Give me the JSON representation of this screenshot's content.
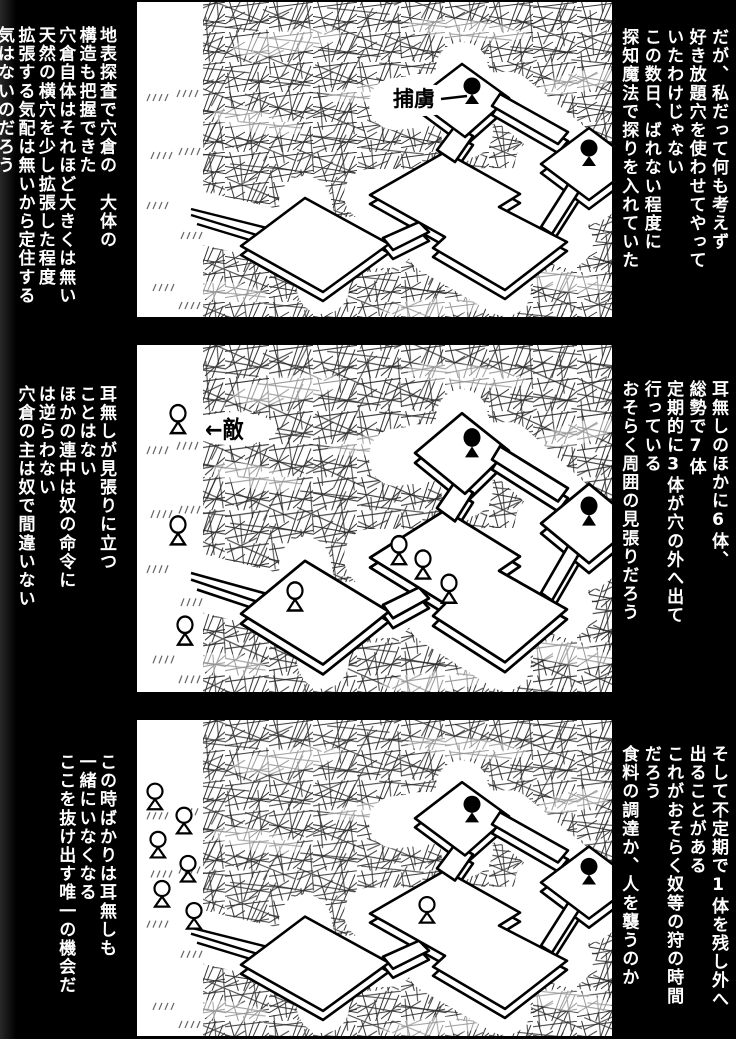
{
  "page": {
    "background": "#000000",
    "panel_background": "#ffffff",
    "ink_color": "#000000",
    "text_color": "#ffffff"
  },
  "panels": [
    {
      "id": "panel-1",
      "map_label": "捕虜",
      "right_text": "だが、私だって何も考えず\n好き放題穴を使わせてやって\nいたわけじゃない\nこの数日、ばれない程度に\n探知魔法で探りを入れていた",
      "left_text": "地表探査で穴倉の　大体の\n構造も把握できた\n穴倉自体はそれほど大きくは無い\n天然の横穴を少し拡張した程度\n拡張する気配は無いから定住する\n気はないのだろう",
      "figures": {
        "captives": [
          [
            335,
            93
          ],
          [
            452,
            155
          ]
        ],
        "enemies_inside": [],
        "enemies_outside": []
      }
    },
    {
      "id": "panel-2",
      "map_label": "←敵",
      "right_text": "耳無しのほかに6体、\n総勢で7体\n定期的に3体が穴の外へ出て\n行っている\nおそらく周囲の見張りだろう",
      "left_text": "耳無しが見張りに立つ\nことはない\nほかの連中は奴の命令に\nは逆らわない\n穴倉の主は奴で間違いない",
      "figures": {
        "captives": [
          [
            335,
            93
          ],
          [
            452,
            155
          ]
        ],
        "enemies_inside": [
          [
            158,
            232
          ],
          [
            262,
            190
          ],
          [
            286,
            203
          ],
          [
            312,
            225
          ]
        ],
        "enemies_outside": [
          [
            41,
            71
          ],
          [
            41,
            172
          ],
          [
            48,
            263
          ]
        ]
      }
    },
    {
      "id": "panel-3",
      "map_label": "",
      "right_text": "そして不定期で1体を残し外へ\n出ることがある\nこれがおそらく奴等の狩の時間\nだろう\n食料の調達か、人を襲うのか",
      "left_text": "この時ばかりは耳無しも\n一緒にいなくなる\nここを抜け出す唯一の機会だ",
      "figures": {
        "captives": [
          [
            335,
            93
          ],
          [
            452,
            155
          ]
        ],
        "enemies_inside": [
          [
            290,
            193
          ]
        ],
        "enemies_outside": [
          [
            18,
            80
          ],
          [
            47,
            104
          ],
          [
            21,
            128
          ],
          [
            51,
            152
          ],
          [
            25,
            177
          ],
          [
            57,
            199
          ]
        ]
      }
    }
  ]
}
